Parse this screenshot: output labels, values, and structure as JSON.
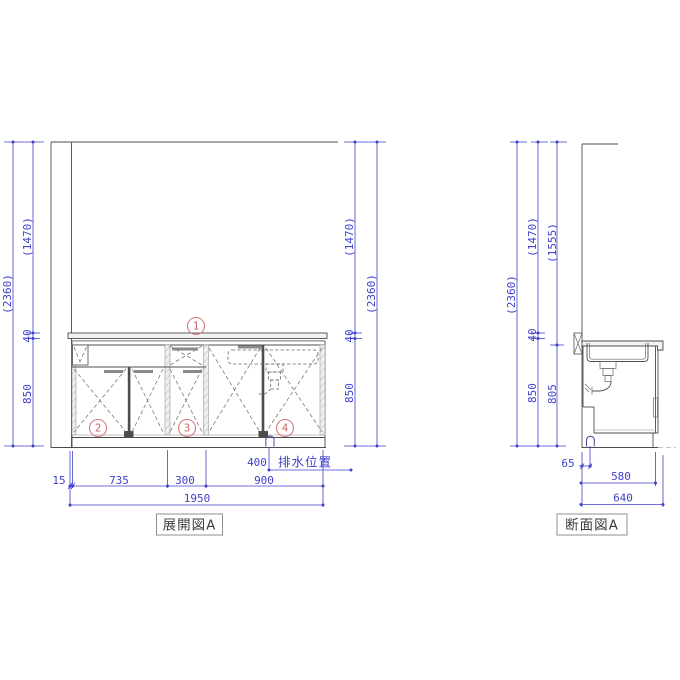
{
  "drawing": {
    "elevation": {
      "label": "展開図A",
      "callouts": {
        "c1": "1",
        "c2": "2",
        "c3": "3",
        "c4": "4"
      },
      "dims": {
        "overall": "(2360)",
        "upper": "(1470)",
        "counter": "40",
        "base": "850",
        "width_filler": "15",
        "width_doors": "735",
        "width_mid": "300",
        "width_sink": "900",
        "width_total": "1950",
        "drain_offset": "400",
        "drain_label": "排水位置"
      }
    },
    "section": {
      "label": "断面図A",
      "dims": {
        "overall": "(2360)",
        "upper": "(1470)",
        "upper_body": "(1555)",
        "counter": "40",
        "base": "850",
        "body": "805",
        "drain_offset": "65",
        "depth": "580",
        "depth_total": "640"
      }
    },
    "colors": {
      "dimension_blue": "#4040cc",
      "line_gray": "#4d4d4d",
      "callout_red": "#d47e7e",
      "background": "#ffffff"
    }
  }
}
